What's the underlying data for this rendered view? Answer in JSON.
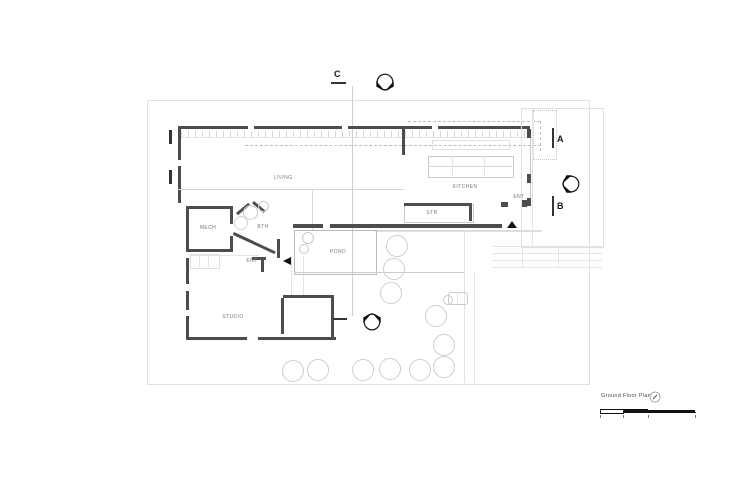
{
  "drawing": {
    "rooms": {
      "living": "LIVING",
      "kitchen": "KITCHEN",
      "stair": "STR",
      "mech": "MECH",
      "bath": "BTH",
      "entry_west": "ENT",
      "entry_east": "ENT",
      "pond": "POND",
      "studio": "STUDIO"
    },
    "section_markers": {
      "a": "A",
      "b": "B",
      "c": "C"
    },
    "title_block": {
      "title": "Ground Floor Plan"
    },
    "colors": {
      "wall_color": "#4d4d4d",
      "annotation_color": "#111111",
      "label_color": "#7a7a7a",
      "light_line_color": "#d8d8d8"
    }
  }
}
